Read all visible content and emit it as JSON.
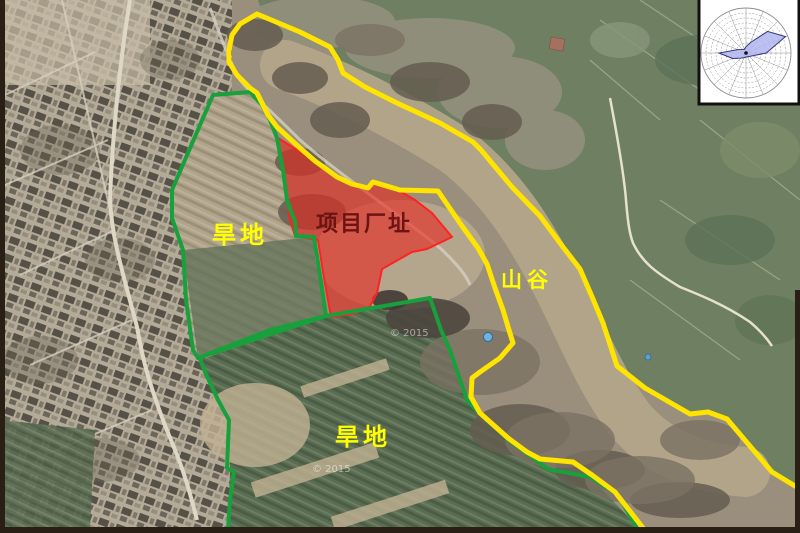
{
  "map": {
    "type": "satellite-annotation-figure",
    "labels": {
      "dryland_upper": "旱地",
      "project_site": "项目厂址",
      "valley": "山谷",
      "dryland_lower": "旱地"
    },
    "watermark": "© 2015",
    "colors": {
      "site_fill": "#e62820",
      "site_stroke": "#ff2222",
      "farmland_boundary_green": "#18a03c",
      "valley_boundary_yellow": "#ffe400",
      "label_yellow": "#ffff00",
      "label_site_text": "#6b1414"
    }
  },
  "chart_data": {
    "type": "wind-rose",
    "title": "",
    "directions_clockwise_from_north": [
      "N",
      "NNE",
      "NE",
      "ENE",
      "E",
      "ESE",
      "SE",
      "SSE",
      "S",
      "SSW",
      "SW",
      "WSW",
      "W",
      "WNW",
      "NW",
      "NNW"
    ],
    "relative_frequency_pct": [
      14,
      25,
      68,
      95,
      45,
      16,
      11,
      9,
      9,
      11,
      16,
      32,
      60,
      20,
      11,
      9
    ],
    "rings": 9,
    "spokes": 16,
    "fill": "#b2b6ee",
    "outline": "#34347e",
    "grid_color": "#8f8f8f",
    "legend_position": "none",
    "note": "wind direction frequency rose, main lobe ENE, secondary lobe W"
  }
}
